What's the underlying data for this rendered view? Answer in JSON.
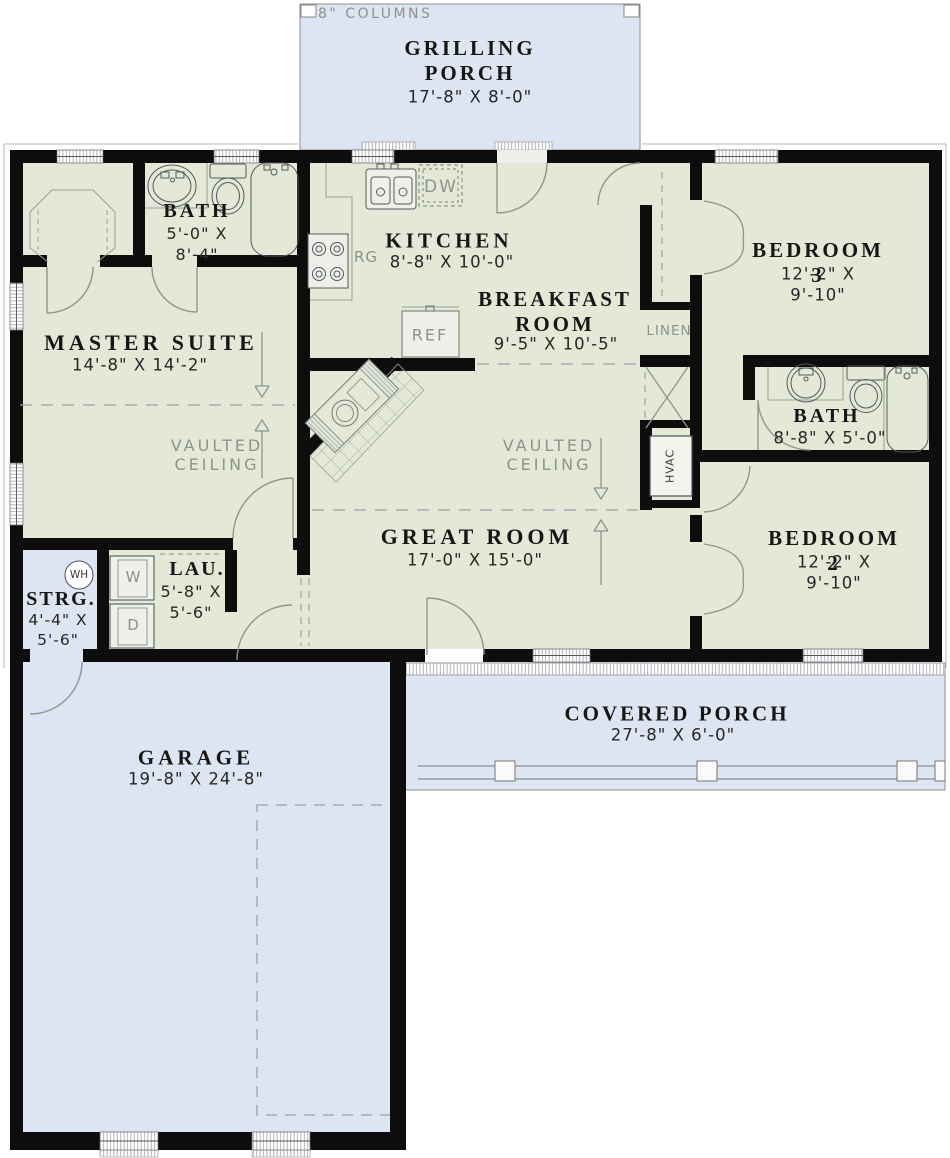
{
  "labels": {
    "columns_note": "8\" COLUMNS",
    "vaulted_ceiling": "VAULTED\nCEILING",
    "linen": "LINEN",
    "hvac": "HVAC"
  },
  "rooms": {
    "grilling_porch": {
      "name": "GRILLING\nPORCH",
      "dims": "17'-8\" X 8'-0\""
    },
    "kitchen": {
      "name": "KITCHEN",
      "dims": "8'-8\" X 10'-0\""
    },
    "breakfast_room": {
      "name": "BREAKFAST\nROOM",
      "dims": "9'-5\" X 10'-5\""
    },
    "bedroom3": {
      "name": "BEDROOM 3",
      "dims": "12'-2\" X 9'-10\""
    },
    "bath_master": {
      "name": "BATH",
      "dims": "5'-0\" X\n8'-4\""
    },
    "master_suite": {
      "name": "MASTER SUITE",
      "dims": "14'-8\" X 14'-2\""
    },
    "bath2": {
      "name": "BATH",
      "dims": "8'-8\" X 5'-0\""
    },
    "great_room": {
      "name": "GREAT ROOM",
      "dims": "17'-0\" X 15'-0\""
    },
    "bedroom2": {
      "name": "BEDROOM 2",
      "dims": "12'-2\" X 9'-10\""
    },
    "laundry": {
      "name": "LAU.",
      "dims": "5'-8\" X\n5'-6\""
    },
    "storage": {
      "name": "STRG.",
      "dims": "4'-4\" X\n5'-6\""
    },
    "garage": {
      "name": "GARAGE",
      "dims": "19'-8\" X 24'-8\""
    },
    "covered_porch": {
      "name": "COVERED PORCH",
      "dims": "27'-8\" X 6'-0\""
    }
  },
  "appliances": {
    "range": "RG",
    "dishwasher": "DW",
    "refrigerator": "REF",
    "washer": "W",
    "dryer": "D",
    "water_heater": "WH"
  },
  "colors": {
    "interior": "#e3e9d6",
    "porch": "#dde4f2",
    "wall": "#0d0d0d",
    "line": "#90948e",
    "text": "#161616",
    "gray_text": "#8e928c"
  }
}
